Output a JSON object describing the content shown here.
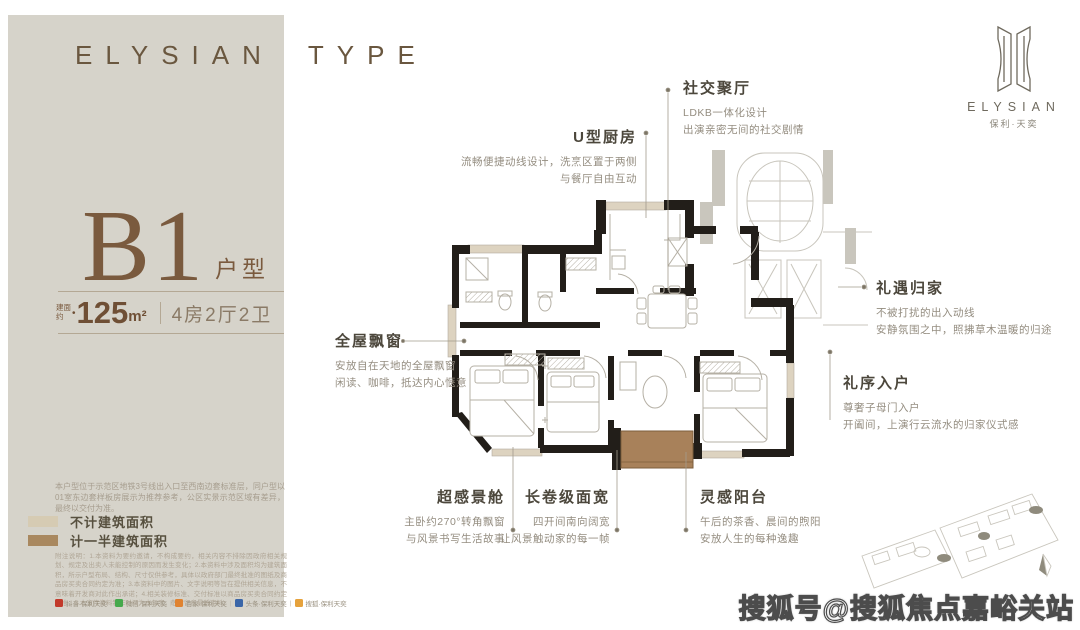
{
  "header": {
    "brand_left": "ELYSIAN",
    "brand_right": "TYPE"
  },
  "logo": {
    "en": "ELYSIAN",
    "cn": "保利·天奕"
  },
  "sidebar": {
    "plan_code": "B1",
    "plan_code_suffix": "户型",
    "area_prefix": [
      "建面",
      "约"
    ],
    "area_dot": "•",
    "area_num": "125",
    "area_unit": "m²",
    "layout": "4房2厅2卫",
    "note": "本户型位于示范区地铁3号线出入口至西南边套标准层，同户型以01室东边套样板房展示为推荐参考，公区实景示范区域有差异，最终以交付为准。",
    "legend": [
      {
        "label": "不计建筑面积",
        "color": "#d6cbb3"
      },
      {
        "label": "计一半建筑面积",
        "color": "#a9885f"
      }
    ],
    "fineprint": "附注说明：1.本资料为要约邀请，不构成要约，相关内容不排除因政府相关规划、规定及出卖人未能控制的原因而发生变化；2.本资料中涉及面积均为建筑面积，所示户型布局、结构、尺寸仅供参考，具体以政府部门最终批准的图纸及商品房买卖合同约定为准；3.本资料中的图片、文字说明等旨在提供相关信息，不意味着开发商对此作出承诺；4.相关装修标准、交付标准以商品房买卖合同约定为准；5.本宣传资料制作时间为本年度，敬请留意最新资料。",
    "social": [
      {
        "color": "#c23a2b",
        "label": "抖音·保利天奕"
      },
      {
        "color": "#46a94c",
        "label": "微信·保利天奕"
      },
      {
        "color": "#e08330",
        "label": "百家·保利天奕"
      },
      {
        "color": "#3a66a8",
        "label": "头条·保利天奕"
      },
      {
        "color": "#e6a23c",
        "label": "搜狐·保利天奕"
      }
    ],
    "social_sep": "|"
  },
  "annotations": {
    "social_hall": {
      "title": "社交聚厅",
      "lines": [
        "LDKB一体化设计",
        "出演亲密无间的社交剧情"
      ]
    },
    "kitchen": {
      "title": "U型厨房",
      "lines": [
        "流畅便捷动线设计，洗烹区置于两侧",
        "与餐厅自由互动"
      ]
    },
    "baywindow": {
      "title": "全屋飘窗",
      "lines": [
        "安放自在天地的全屋飘窗",
        "闲读、咖啡，抵达内心惬意"
      ]
    },
    "viewcabin": {
      "title": "超感景舱",
      "lines": [
        "主卧约270°转角飘窗",
        "与风景书写生活故事"
      ]
    },
    "widefront": {
      "title": "长卷级面宽",
      "lines": [
        "四开间南向阔宽",
        "让风景触动家的每一帧"
      ]
    },
    "balcony": {
      "title": "灵感阳台",
      "lines": [
        "午后的茶香、晨间的煦阳",
        "安放人生的每种逸趣"
      ]
    },
    "homecoming": {
      "title": "礼遇归家",
      "lines": [
        "不被打扰的出入动线",
        "安静氛围之中，照拂草木温暖的归途"
      ]
    },
    "entry": {
      "title": "礼序入户",
      "lines": [
        "尊奢子母门入户",
        "开阖间，上演行云流水的归家仪式感"
      ]
    }
  },
  "watermark": "搜狐号@搜狐焦点嘉峪关站",
  "colors": {
    "panel": "#d6d3ca",
    "accent_brown": "#7a5a3e",
    "balcony_fill": "#a8815a"
  }
}
